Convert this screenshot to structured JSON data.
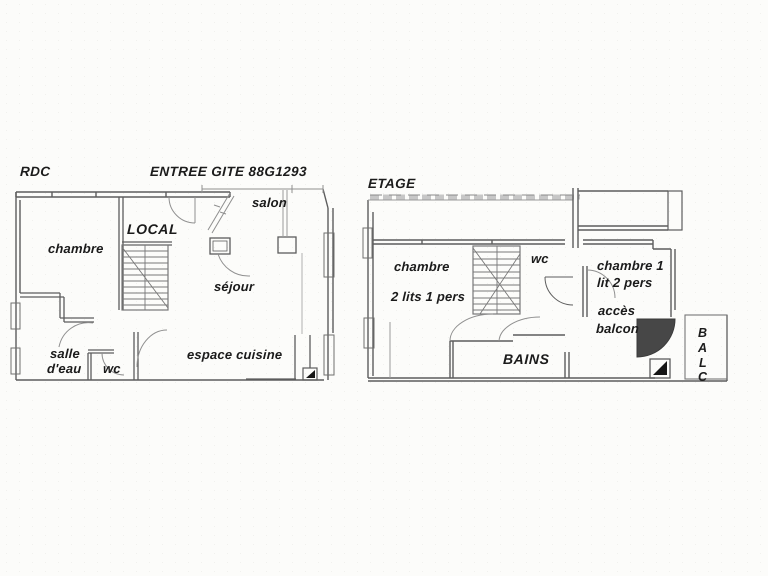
{
  "colors": {
    "wall": "#5d5d5d",
    "thin_wall": "#8f8f8f",
    "text": "#1b1b1b",
    "roof_band": "#b5b5b5",
    "door_fill": "#474747",
    "corner_fill": "#151515"
  },
  "rdc": {
    "floor_label": "RDC",
    "title": "ENTREE GITE 88G1293",
    "labels": {
      "salon": "salon",
      "local": "LOCAL",
      "chambre": "chambre",
      "sejour": "séjour",
      "salle_eau": [
        "salle",
        "d'eau"
      ],
      "wc": "wc",
      "espace_cuisine": "espace cuisine"
    }
  },
  "etage": {
    "floor_label": "ETAGE",
    "labels": {
      "chambre": "chambre",
      "chambre_beds": "2 lits 1 pers",
      "wc": "wc",
      "chambre1": "chambre 1",
      "chambre1_bed": "lit 2 pers",
      "acces": "accès",
      "balcon": "balcon",
      "bains": "BAINS",
      "balcon_letters": [
        "B",
        "A",
        "L",
        "C"
      ]
    }
  }
}
